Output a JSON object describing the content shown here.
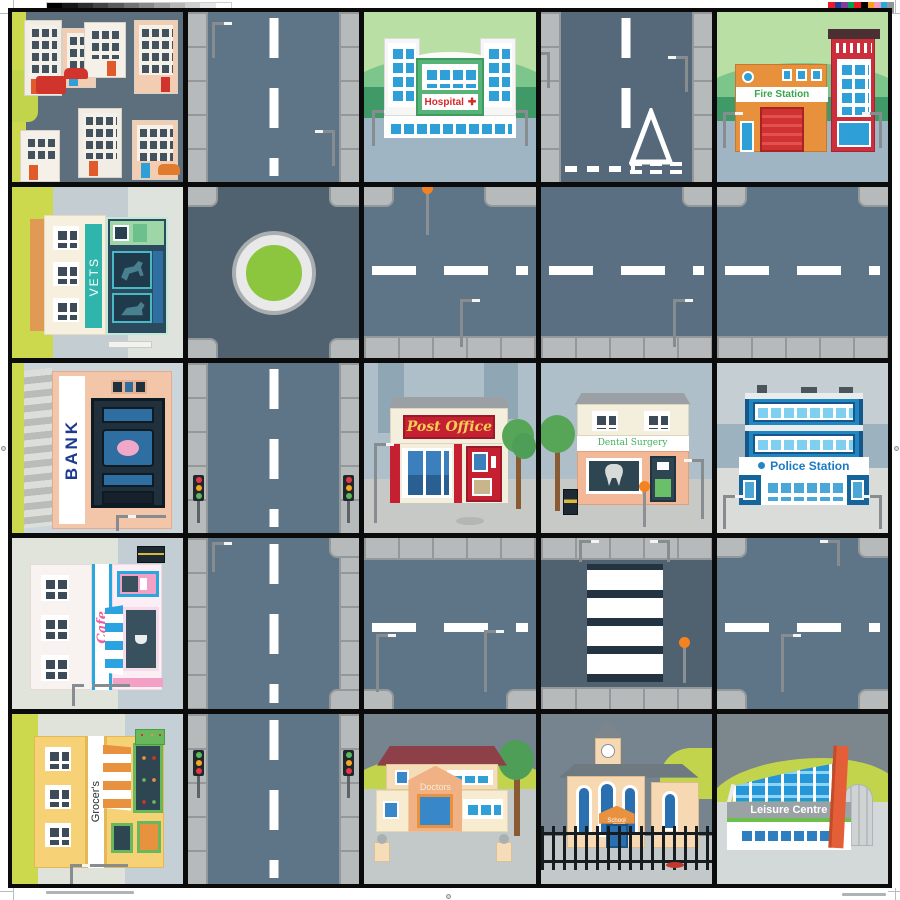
{
  "artwork": {
    "kind": "children town playmat map",
    "grid": {
      "rows": 5,
      "cols": 5,
      "line_color": "#0b0b0b",
      "page_background": "#ffffff"
    }
  },
  "buildings": {
    "hospital": {
      "label": "Hospital",
      "cross_icon": "✚",
      "label_color": "#d42a2a"
    },
    "fire_station": {
      "label": "Fire Station",
      "label_color": "#3aa54a"
    },
    "vets": {
      "label": "VETS",
      "label_color": "#ffffff",
      "sign_color": "#2fb5ac"
    },
    "bank": {
      "label": "BANK",
      "label_color": "#1e3a8f"
    },
    "post_office": {
      "label": "Post Office",
      "label_color": "#f3cf57",
      "sign_color": "#c42031"
    },
    "dental": {
      "label": "Dental Surgery",
      "label_color": "#43b05c"
    },
    "police": {
      "label": "Police Station",
      "label_color": "#1a7ac2"
    },
    "cafe": {
      "label": "Cafe",
      "label_color": "#ec5f9e"
    },
    "grocers": {
      "label": "Grocer's",
      "label_color": "#2c2c2c"
    },
    "doctors": {
      "label": "Doctors",
      "label_color": "#f7ecd8"
    },
    "school": {
      "label": "School",
      "label_color": "#ffffff",
      "sign_color": "#e8923f"
    },
    "leisure": {
      "label": "Leisure Centre",
      "label_color": "#ffffff",
      "band_color": "#9aa2a6"
    }
  },
  "tiles": [
    {
      "row": 1,
      "col": 1,
      "type": "residential-houses"
    },
    {
      "row": 1,
      "col": 2,
      "type": "road-vertical"
    },
    {
      "row": 1,
      "col": 3,
      "type": "hospital"
    },
    {
      "row": 1,
      "col": 4,
      "type": "road-vertical-give-way"
    },
    {
      "row": 1,
      "col": 5,
      "type": "fire-station"
    },
    {
      "row": 2,
      "col": 1,
      "type": "vets"
    },
    {
      "row": 2,
      "col": 2,
      "type": "roundabout"
    },
    {
      "row": 2,
      "col": 3,
      "type": "road-horizontal"
    },
    {
      "row": 2,
      "col": 4,
      "type": "road-horizontal"
    },
    {
      "row": 2,
      "col": 5,
      "type": "road-horizontal"
    },
    {
      "row": 3,
      "col": 1,
      "type": "bank"
    },
    {
      "row": 3,
      "col": 2,
      "type": "road-vertical-traffic-lights"
    },
    {
      "row": 3,
      "col": 3,
      "type": "post-office"
    },
    {
      "row": 3,
      "col": 4,
      "type": "dental-surgery"
    },
    {
      "row": 3,
      "col": 5,
      "type": "police-station"
    },
    {
      "row": 4,
      "col": 1,
      "type": "cafe"
    },
    {
      "row": 4,
      "col": 2,
      "type": "road-vertical"
    },
    {
      "row": 4,
      "col": 3,
      "type": "road-horizontal"
    },
    {
      "row": 4,
      "col": 4,
      "type": "zebra-crossing"
    },
    {
      "row": 4,
      "col": 5,
      "type": "road-horizontal"
    },
    {
      "row": 5,
      "col": 1,
      "type": "grocers"
    },
    {
      "row": 5,
      "col": 2,
      "type": "road-vertical-traffic-lights"
    },
    {
      "row": 5,
      "col": 3,
      "type": "doctors"
    },
    {
      "row": 5,
      "col": 4,
      "type": "school"
    },
    {
      "row": 5,
      "col": 5,
      "type": "leisure-centre"
    }
  ],
  "palette": {
    "road": "#5e7487",
    "road_dark": "#50626f",
    "sidewalk": "#b6babb",
    "lime": "#ccd94d",
    "roundabout_green": "#8cc63e",
    "beacon_orange": "#f58220",
    "hill_light": "#b9dfa5",
    "hill_mid": "#7cc68b",
    "hill_dark": "#3f9a68",
    "sky_slate": "#75848f",
    "pavement_blue": "#9fb5c3"
  },
  "print_marks": {
    "grayscale_bar": [
      "#000000",
      "#161616",
      "#2d2d2d",
      "#444444",
      "#5b5b5b",
      "#727272",
      "#898989",
      "#a0a0a0",
      "#b7b7b7",
      "#cecece",
      "#e5e5e5",
      "#ffffff"
    ],
    "color_bar": [
      "#ed1c24",
      "#21409a",
      "#7f3f98",
      "#00a651",
      "#ed1c24",
      "#000000",
      "#f9a11b",
      "#f49ac1",
      "#26a9e0",
      "#939598"
    ]
  }
}
